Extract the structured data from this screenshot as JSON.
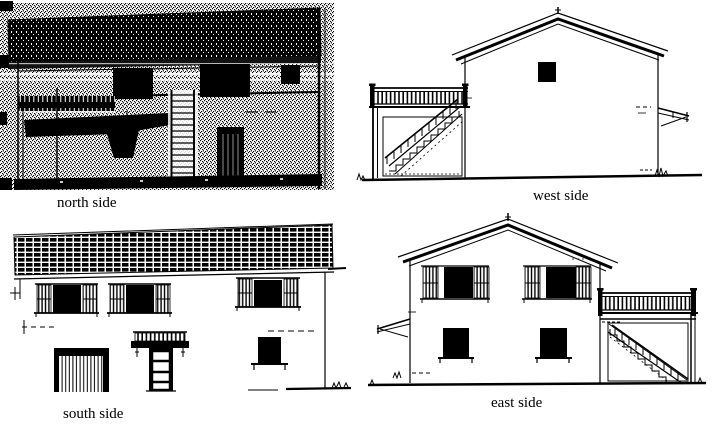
{
  "page": {
    "background_color": "#ffffff",
    "ink_color": "#000000"
  },
  "figure": {
    "elevations": [
      {
        "id": "north",
        "label": "north side"
      },
      {
        "id": "west",
        "label": "west side"
      },
      {
        "id": "south",
        "label": "south side"
      },
      {
        "id": "east",
        "label": "east side"
      }
    ]
  }
}
